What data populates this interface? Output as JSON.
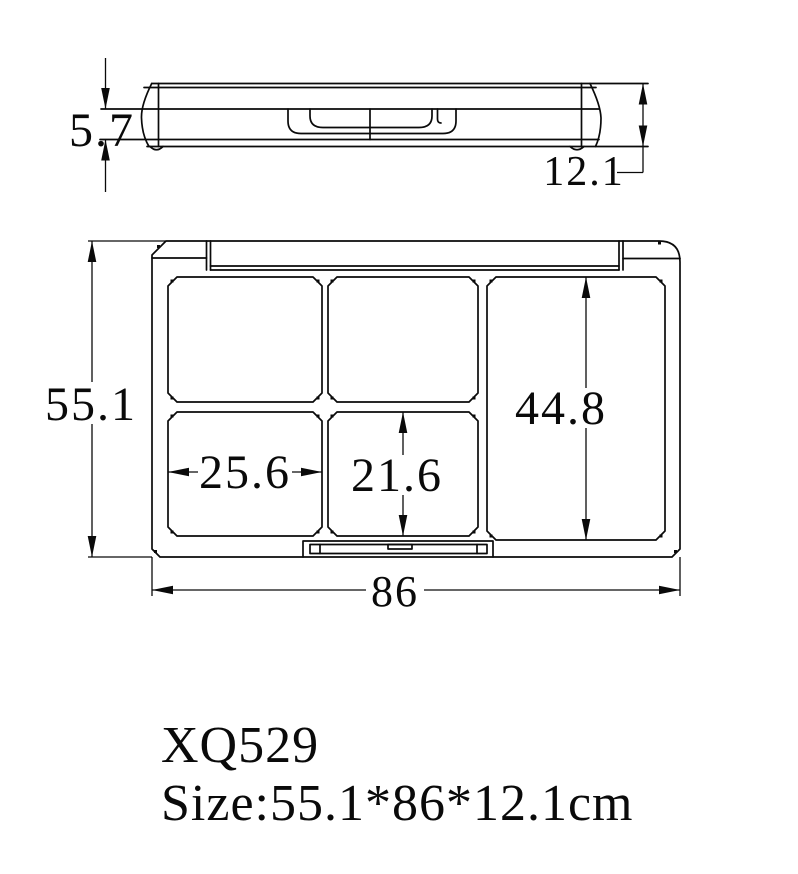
{
  "page": {
    "background_color": "#ffffff",
    "line_color": "#0a0a0a"
  },
  "title_block": {
    "product_code": "XQ529",
    "size_caption": "Size:55.1*86*12.1cm"
  },
  "side_view": {
    "description": "side profile of closed compact case",
    "dim_lid_height": "5.7",
    "dim_total_height": "12.1"
  },
  "top_view": {
    "description": "open-case plan view with five pans",
    "dim_overall_height": "55.1",
    "dim_overall_width": "86",
    "dim_right_pan_height": "44.8",
    "dim_pan_width": "25.6",
    "dim_pan_height": "21.6"
  }
}
